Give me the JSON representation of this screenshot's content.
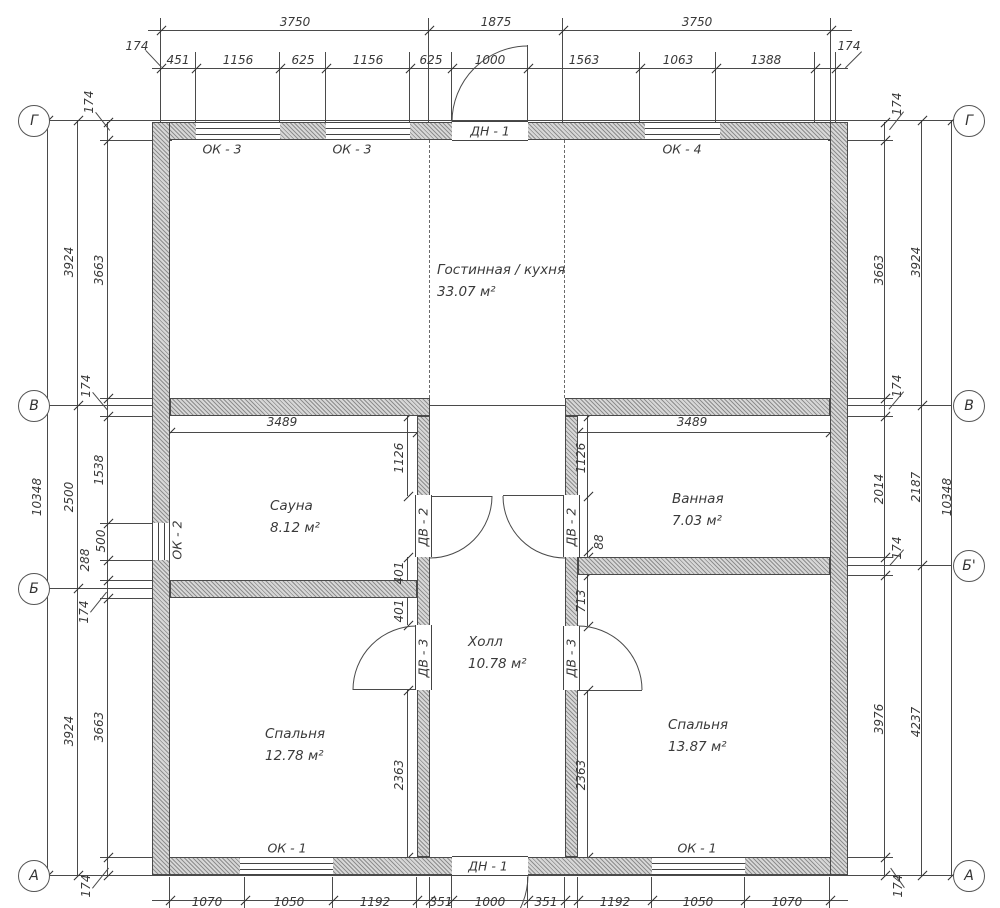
{
  "drawing": {
    "kind": "architectural floor plan",
    "units": "mm",
    "line_color": "#4a4a4a"
  },
  "axis_markers": {
    "left": [
      {
        "label": "Г",
        "y": 120
      },
      {
        "label": "В",
        "y": 405
      },
      {
        "label": "Б",
        "y": 588
      },
      {
        "label": "А",
        "y": 875
      }
    ],
    "right": [
      {
        "label": "Г",
        "y": 120
      },
      {
        "label": "В",
        "y": 405
      },
      {
        "label": "Б'",
        "y": 565
      },
      {
        "label": "А",
        "y": 875
      }
    ]
  },
  "rooms": [
    {
      "name": "Гостинная / кухня",
      "area": "33.07 м²",
      "x": 437,
      "y": 270
    },
    {
      "name": "Сауна",
      "area": "8.12 м²",
      "x": 270,
      "y": 506
    },
    {
      "name": "Ванная",
      "area": "7.03 м²",
      "x": 672,
      "y": 499
    },
    {
      "name": "Холл",
      "area": "10.78 м²",
      "x": 468,
      "y": 642
    },
    {
      "name": "Спальня",
      "area": "12.78 м²",
      "x": 265,
      "y": 734
    },
    {
      "name": "Спальня",
      "area": "13.87 м²",
      "x": 668,
      "y": 725
    }
  ],
  "opening_labels": [
    {
      "t": "ОК - 3",
      "x": 222,
      "y": 149,
      "r": 0
    },
    {
      "t": "ОК - 3",
      "x": 352,
      "y": 149,
      "r": 0
    },
    {
      "t": "ДН - 1",
      "x": 490,
      "y": 131,
      "r": 0
    },
    {
      "t": "ОК - 4",
      "x": 682,
      "y": 149,
      "r": 0
    },
    {
      "t": "ОК - 2",
      "x": 177,
      "y": 540,
      "r": -90
    },
    {
      "t": "ДВ - 2",
      "x": 423,
      "y": 527,
      "r": -90
    },
    {
      "t": "ДВ - 2",
      "x": 571,
      "y": 527,
      "r": -90
    },
    {
      "t": "ДВ - 3",
      "x": 423,
      "y": 658,
      "r": -90
    },
    {
      "t": "ДВ - 3",
      "x": 571,
      "y": 658,
      "r": -90
    },
    {
      "t": "ОК - 1",
      "x": 287,
      "y": 848,
      "r": 0
    },
    {
      "t": "ДН - 1",
      "x": 488,
      "y": 866,
      "r": 0
    },
    {
      "t": "ОК - 1",
      "x": 697,
      "y": 848,
      "r": 0
    }
  ],
  "dim_labels": [
    {
      "t": "3750",
      "x": 295,
      "y": 22,
      "r": 0
    },
    {
      "t": "1875",
      "x": 496,
      "y": 22,
      "r": 0
    },
    {
      "t": "3750",
      "x": 697,
      "y": 22,
      "r": 0
    },
    {
      "t": "174",
      "x": 137,
      "y": 46,
      "r": 0
    },
    {
      "t": "174",
      "x": 849,
      "y": 46,
      "r": 0
    },
    {
      "t": "451",
      "x": 178,
      "y": 60,
      "r": 0
    },
    {
      "t": "1156",
      "x": 238,
      "y": 60,
      "r": 0
    },
    {
      "t": "625",
      "x": 303,
      "y": 60,
      "r": 0
    },
    {
      "t": "1156",
      "x": 368,
      "y": 60,
      "r": 0
    },
    {
      "t": "625",
      "x": 431,
      "y": 60,
      "r": 0
    },
    {
      "t": "1000",
      "x": 490,
      "y": 60,
      "r": 0
    },
    {
      "t": "1563",
      "x": 584,
      "y": 60,
      "r": 0
    },
    {
      "t": "1063",
      "x": 678,
      "y": 60,
      "r": 0
    },
    {
      "t": "1388",
      "x": 766,
      "y": 60,
      "r": 0
    },
    {
      "t": "1070",
      "x": 207,
      "y": 902,
      "r": 0
    },
    {
      "t": "1050",
      "x": 289,
      "y": 902,
      "r": 0
    },
    {
      "t": "1192",
      "x": 375,
      "y": 902,
      "r": 0
    },
    {
      "t": "351",
      "x": 441,
      "y": 902,
      "r": 0
    },
    {
      "t": "1000",
      "x": 490,
      "y": 902,
      "r": 0
    },
    {
      "t": "351",
      "x": 546,
      "y": 902,
      "r": 0
    },
    {
      "t": "1192",
      "x": 615,
      "y": 902,
      "r": 0
    },
    {
      "t": "1050",
      "x": 698,
      "y": 902,
      "r": 0
    },
    {
      "t": "1070",
      "x": 787,
      "y": 902,
      "r": 0
    },
    {
      "t": "10348",
      "x": 37,
      "y": 497,
      "r": -90
    },
    {
      "t": "3924",
      "x": 69,
      "y": 262,
      "r": -90
    },
    {
      "t": "2500",
      "x": 69,
      "y": 497,
      "r": -90
    },
    {
      "t": "3924",
      "x": 69,
      "y": 731,
      "r": -90
    },
    {
      "t": "3663",
      "x": 99,
      "y": 270,
      "r": -90
    },
    {
      "t": "1538",
      "x": 99,
      "y": 470,
      "r": -90
    },
    {
      "t": "500",
      "x": 101,
      "y": 541,
      "r": -90
    },
    {
      "t": "288",
      "x": 85,
      "y": 560,
      "r": -90
    },
    {
      "t": "3663",
      "x": 99,
      "y": 727,
      "r": -90
    },
    {
      "t": "174",
      "x": 89,
      "y": 102,
      "r": -90
    },
    {
      "t": "174",
      "x": 86,
      "y": 386,
      "r": -90
    },
    {
      "t": "174",
      "x": 84,
      "y": 612,
      "r": -90
    },
    {
      "t": "174",
      "x": 86,
      "y": 886,
      "r": -90
    },
    {
      "t": "10348",
      "x": 947,
      "y": 497,
      "r": -90
    },
    {
      "t": "3924",
      "x": 916,
      "y": 262,
      "r": -90
    },
    {
      "t": "2187",
      "x": 916,
      "y": 487,
      "r": -90
    },
    {
      "t": "4237",
      "x": 916,
      "y": 722,
      "r": -90
    },
    {
      "t": "3663",
      "x": 879,
      "y": 270,
      "r": -90
    },
    {
      "t": "2014",
      "x": 879,
      "y": 489,
      "r": -90
    },
    {
      "t": "3976",
      "x": 879,
      "y": 719,
      "r": -90
    },
    {
      "t": "174",
      "x": 897,
      "y": 104,
      "r": -90
    },
    {
      "t": "174",
      "x": 897,
      "y": 386,
      "r": -90
    },
    {
      "t": "174",
      "x": 897,
      "y": 548,
      "r": -90
    },
    {
      "t": "174",
      "x": 898,
      "y": 886,
      "r": -90
    },
    {
      "t": "3489",
      "x": 282,
      "y": 422,
      "r": 0
    },
    {
      "t": "3489",
      "x": 692,
      "y": 422,
      "r": 0
    },
    {
      "t": "1126",
      "x": 399,
      "y": 458,
      "r": -90
    },
    {
      "t": "1126",
      "x": 581,
      "y": 458,
      "r": -90
    },
    {
      "t": "401",
      "x": 399,
      "y": 573,
      "r": -90
    },
    {
      "t": "401",
      "x": 399,
      "y": 611,
      "r": -90
    },
    {
      "t": "713",
      "x": 581,
      "y": 601,
      "r": -90
    },
    {
      "t": "88",
      "x": 599,
      "y": 542,
      "r": -90
    },
    {
      "t": "2363",
      "x": 399,
      "y": 775,
      "r": -90
    },
    {
      "t": "2363",
      "x": 581,
      "y": 775,
      "r": -90
    }
  ]
}
